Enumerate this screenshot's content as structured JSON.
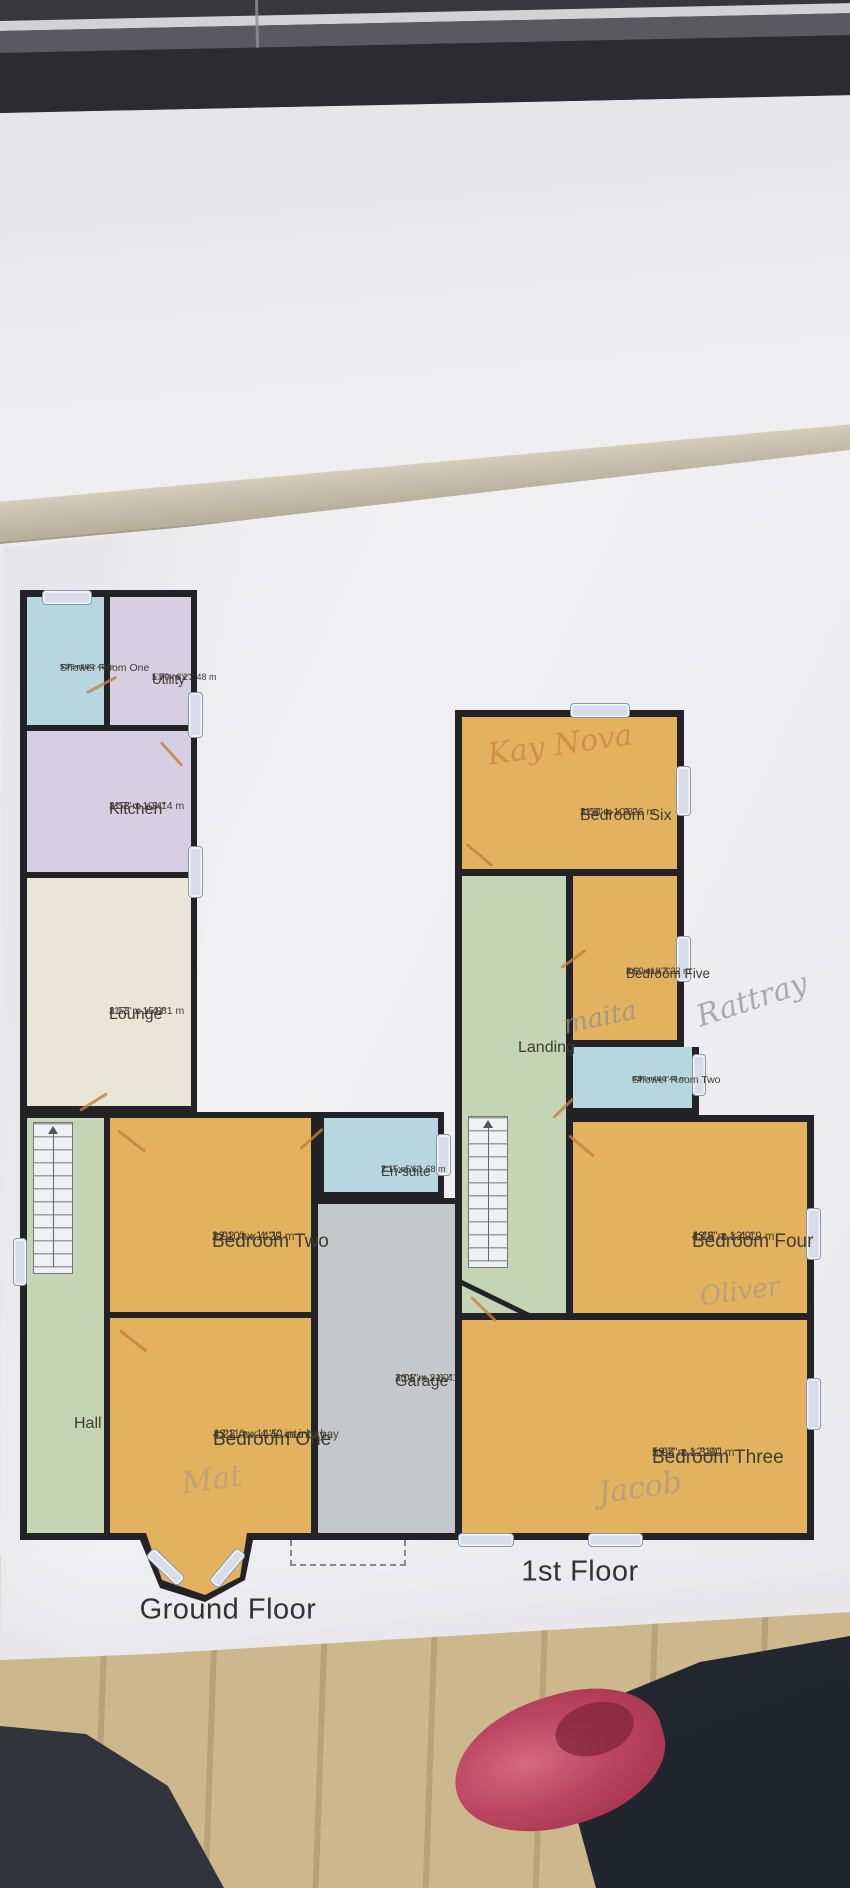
{
  "colors": {
    "wall": "#232227",
    "bedroom_fill": "#e3b25f",
    "kitchen_fill": "#d6cee2",
    "lounge_fill": "#e9e6d7",
    "shower_fill": "#b6d7e0",
    "hall_fill": "#c6d4b6",
    "garage_fill": "#c5c8cb",
    "window_symbol": "#d6dde9",
    "door_symbol": "#bf8142",
    "label_text": "#3f3b33",
    "title_text": "#323234"
  },
  "ground_floor": {
    "title": "Ground Floor",
    "rooms": {
      "shower_room_one": {
        "name": "Shower Room One",
        "metric": "1.73 m x 2.48 m",
        "imperial": "5'8\" x 8'2\""
      },
      "utility": {
        "name": "Utility",
        "metric": "1.70 m x 2.48 m",
        "imperial": "5'7\" x 8'2\""
      },
      "kitchen": {
        "name": "Kitchen",
        "metric": "3.53 m x 3.14 m",
        "imperial": "11'7\" x 10'4\""
      },
      "lounge": {
        "name": "Lounge",
        "metric": "3.53 m x 4.81 m",
        "imperial": "11'7\" x 15'9\""
      },
      "en_suite": {
        "name": "En-suite",
        "metric": "2.15 m x 1.68 m",
        "imperial": "7'1\" x 5'6\""
      },
      "bedroom_two": {
        "name": "Bedroom Two",
        "metric": "3.92 m x 4.29 m",
        "imperial": "12'10\" x 14'1\""
      },
      "bedroom_one": {
        "name": "Bedroom One",
        "metric": "4.23 m x 4.40 m into bay",
        "imperial": "13'11\" x 14'5\" into bay"
      },
      "hall": {
        "name": "Hall"
      },
      "garage": {
        "name": "Garage",
        "metric": "3.08 m x 6.41 m",
        "imperial": "10'1\" x 21'0\""
      }
    }
  },
  "first_floor": {
    "title": "1st Floor",
    "rooms": {
      "bedroom_six": {
        "name": "Bedroom Six",
        "metric": "3.56 m x 3.26 m",
        "imperial": "11'8\" x 10'8\""
      },
      "bedroom_five": {
        "name": "Bedroom Five",
        "metric": "2.60 m x 3.22 m",
        "imperial": "8'6\" x 10'7\""
      },
      "landing": {
        "name": "Landing"
      },
      "shower_room_two": {
        "name": "Shower Room Two",
        "metric": "2.07 m x 1.46 m",
        "imperial": "6'9\" x 4'10\""
      },
      "bedroom_four": {
        "name": "Bedroom Four",
        "metric": "4.16 m x 4.19 m",
        "imperial": "13'8\" x 13'9\""
      },
      "bedroom_three": {
        "name": "Bedroom Three",
        "metric": "5.98 m x 3.90 m",
        "imperial": "19'7\" x 12'10\""
      }
    }
  },
  "handwriting": {
    "bedroom_six_note": "Kay Nova",
    "bedroom_five_note": "maita",
    "bedroom_five_surname_note": "Rattray",
    "bedroom_four_note": "Oliver",
    "bedroom_three_note": "Jacob",
    "bedroom_one_note": "Mat"
  }
}
